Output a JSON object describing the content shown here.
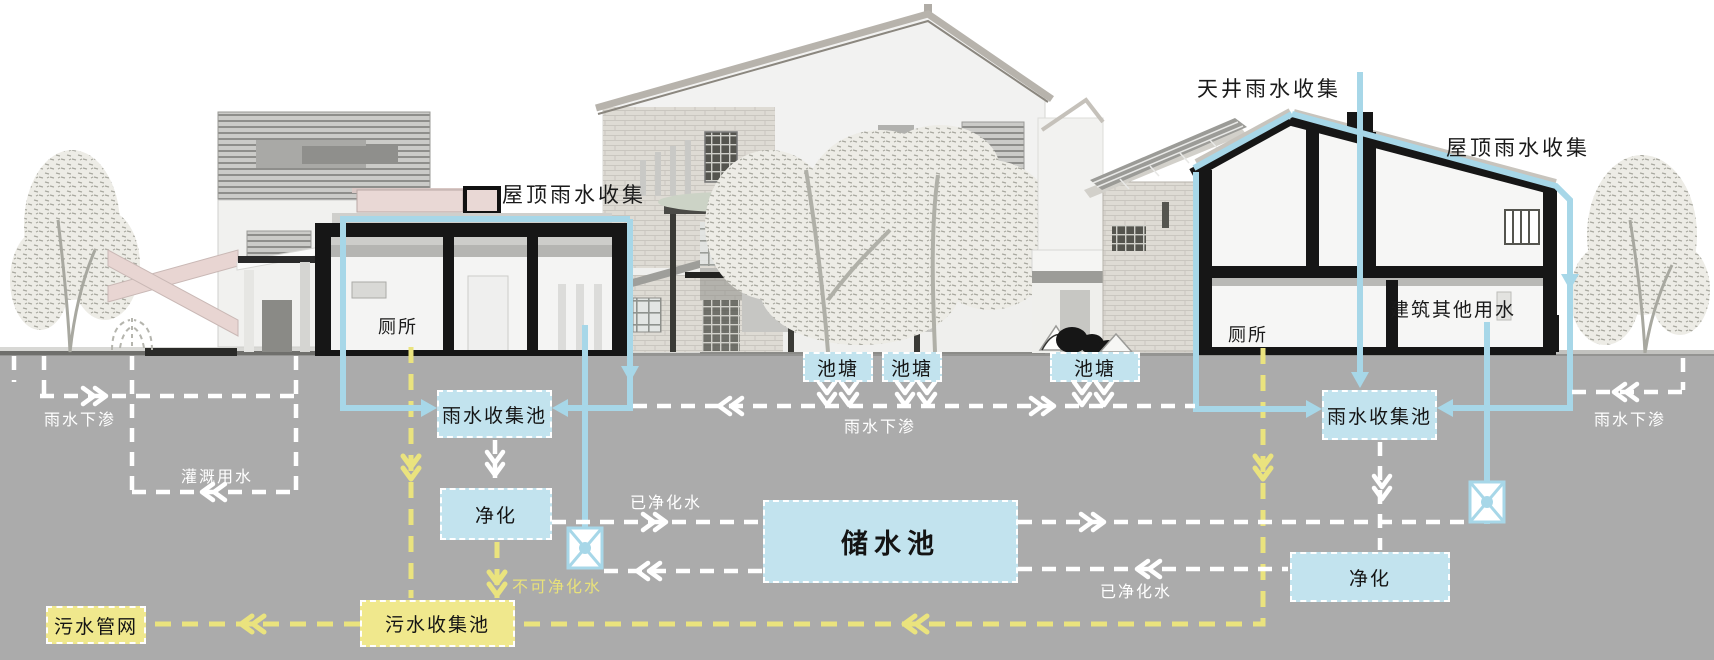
{
  "labels": {
    "roof_rain_left": "屋顶雨水收集",
    "courtyard_rain": "天井雨水收集",
    "roof_rain_right": "屋顶雨水收集",
    "toilet_left": "厕所",
    "toilet_right": "厕所",
    "building_other_water": "建筑其他用水",
    "infiltration_left": "雨水下渗",
    "infiltration_middle": "雨水下渗",
    "infiltration_right": "雨水下渗",
    "irrigation_water": "灌溉用水",
    "purified_water_left": "已净化水",
    "purified_water_right": "已净化水",
    "unpurifiable_water": "不可净化水"
  },
  "boxes": {
    "pond_1": "池塘",
    "pond_2": "池塘",
    "pond_3": "池塘",
    "rain_pool_left": "雨水收集池",
    "rain_pool_right": "雨水收集池",
    "purify_left": "净化",
    "purify_right": "净化",
    "storage_pool": "储水池",
    "sewage_pool": "污水收集池",
    "sewage_network": "污水管网"
  },
  "colors": {
    "water_box_fill": "#c2e3ee",
    "pipe_blue": "#a7d7e8",
    "sewage_box_fill": "#f0e88d",
    "sewage_dash": "#eae37e",
    "flow_dash_white": "#ffffff",
    "ground_gray": "#ababab"
  }
}
